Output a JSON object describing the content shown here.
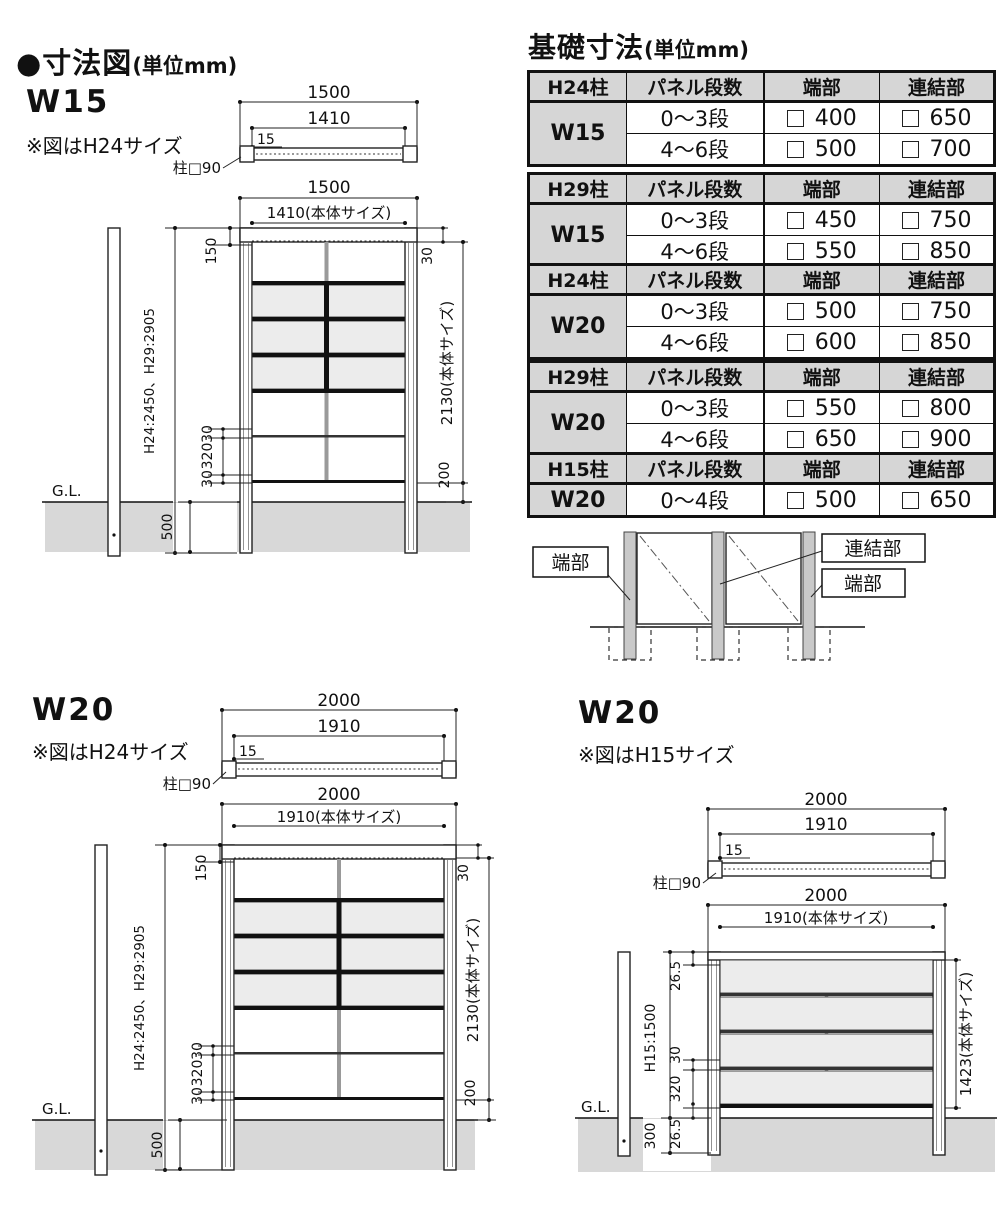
{
  "page": {
    "title": "●寸法図",
    "title_unit": "(単位mm)"
  },
  "colors": {
    "ground": "#d8d8d8",
    "panel_row_fill": "#ececec",
    "table_header": "#d6d6d6",
    "diagram_post": "#c9c9c9"
  },
  "foundation": {
    "title": "基礎寸法",
    "title_unit": "(単位mm)",
    "headers": {
      "steps": "パネル段数",
      "edge": "端部",
      "joint": "連結部"
    },
    "tables": [
      {
        "post": "H24柱",
        "width": "W15",
        "rows": [
          {
            "steps": "0〜3段",
            "edge": "400",
            "joint": "650"
          },
          {
            "steps": "4〜6段",
            "edge": "500",
            "joint": "700"
          }
        ]
      },
      {
        "post": "H29柱",
        "width": "W15",
        "rows": [
          {
            "steps": "0〜3段",
            "edge": "450",
            "joint": "750"
          },
          {
            "steps": "4〜6段",
            "edge": "550",
            "joint": "850"
          }
        ]
      },
      {
        "post": "H24柱",
        "width": "W20",
        "rows": [
          {
            "steps": "0〜3段",
            "edge": "500",
            "joint": "750"
          },
          {
            "steps": "4〜6段",
            "edge": "600",
            "joint": "850"
          }
        ]
      },
      {
        "post": "H29柱",
        "width": "W20",
        "rows": [
          {
            "steps": "0〜3段",
            "edge": "550",
            "joint": "800"
          },
          {
            "steps": "4〜6段",
            "edge": "650",
            "joint": "900"
          }
        ]
      },
      {
        "post": "H15柱",
        "width": "W20",
        "rows": [
          {
            "steps": "0〜4段",
            "edge": "500",
            "joint": "650"
          }
        ]
      }
    ]
  },
  "post_diagram": {
    "edge_left": "端部",
    "joint": "連結部",
    "edge_right": "端部"
  },
  "w15": {
    "label": "W15",
    "note": "※図はH24サイズ",
    "top": {
      "overall": "1500",
      "body": "1410",
      "offset": "15",
      "post": "柱□90"
    },
    "front": {
      "overall": "1500",
      "body": "1410(本体サイズ)",
      "top_offset": "150",
      "rail": "30",
      "post_height": "H24:2450、H29:2905",
      "body_height": "2130(本体サイズ)",
      "d30a": "30",
      "d320": "320",
      "d30b": "30",
      "gap": "200",
      "embed": "500",
      "gl": "G.L."
    }
  },
  "w20a": {
    "label": "W20",
    "note": "※図はH24サイズ",
    "top": {
      "overall": "2000",
      "body": "1910",
      "offset": "15",
      "post": "柱□90"
    },
    "front": {
      "overall": "2000",
      "body": "1910(本体サイズ)",
      "top_offset": "150",
      "rail": "30",
      "post_height": "H24:2450、H29:2905",
      "body_height": "2130(本体サイズ)",
      "d30a": "30",
      "d320": "320",
      "d30b": "30",
      "gap": "200",
      "embed": "500",
      "gl": "G.L."
    }
  },
  "w20b": {
    "label": "W20",
    "note": "※図はH15サイズ",
    "top": {
      "overall": "2000",
      "body": "1910",
      "offset": "15",
      "post": "柱□90"
    },
    "front": {
      "overall": "2000",
      "body": "1910(本体サイズ)",
      "top_offset": "26.5",
      "post_height": "H15:1500",
      "d30": "30",
      "d320": "320",
      "d265": "26.5",
      "embed": "300",
      "body_height": "1423(本体サイズ)",
      "gl": "G.L."
    }
  }
}
